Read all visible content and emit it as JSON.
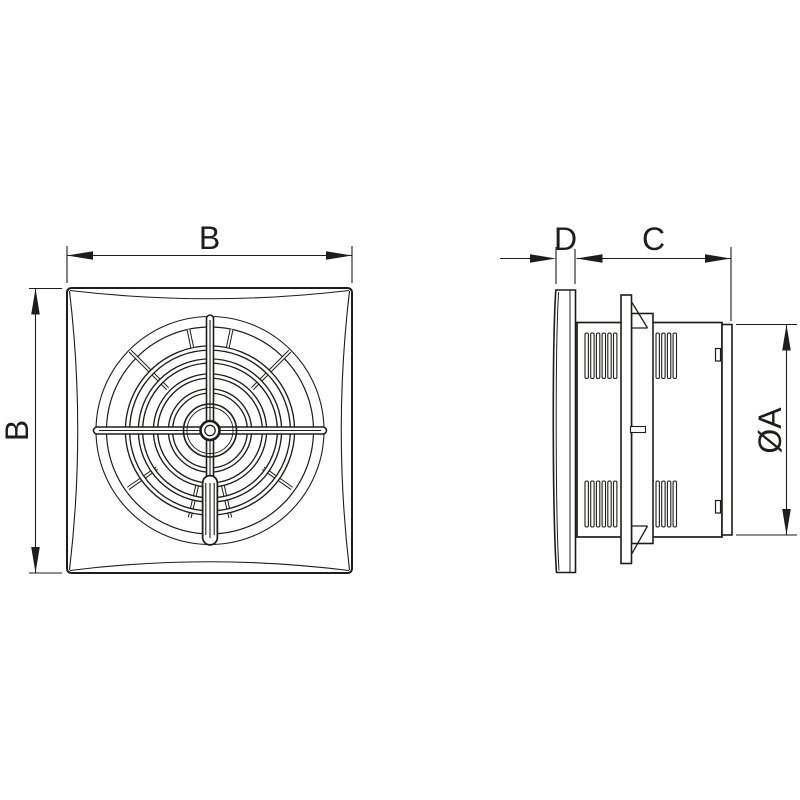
{
  "drawing": {
    "background": "#ffffff",
    "line_color": "#1d1d1b",
    "front_view": {
      "width_label": "B",
      "height_label": "B"
    },
    "side_view": {
      "panel_depth_label": "D",
      "body_depth_label": "C",
      "diameter_label": "ØA"
    }
  }
}
